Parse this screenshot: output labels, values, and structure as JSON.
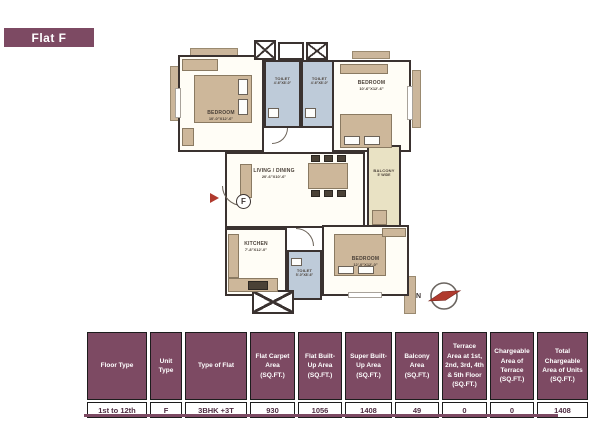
{
  "header": {
    "title": "Flat F"
  },
  "plan": {
    "rooms": [
      {
        "id": "bedroom-top-left",
        "name": "BEDROOM",
        "dims": "10'-0\"X12'-6\""
      },
      {
        "id": "toilet-top-1",
        "name": "TOILET",
        "dims": "4'-6\"X8'-0\""
      },
      {
        "id": "toilet-top-2",
        "name": "TOILET",
        "dims": "4'-6\"X8'-0\""
      },
      {
        "id": "bedroom-top-right",
        "name": "BEDROOM",
        "dims": "10'-6\"X12'-6\""
      },
      {
        "id": "living-dining",
        "name": "LIVING / DINING",
        "dims": "20'-6\"X10'-6\""
      },
      {
        "id": "balcony",
        "name": "BALCONY",
        "dims": "5' WIDE"
      },
      {
        "id": "kitchen",
        "name": "KITCHEN",
        "dims": "7'-8\"X12'-0\""
      },
      {
        "id": "toilet-bottom",
        "name": "TOILET",
        "dims": "5'-0\"X8'-6\""
      },
      {
        "id": "bedroom-bottom-right",
        "name": "BEDROOM",
        "dims": "12'-0\"X12'-0\""
      }
    ],
    "entrance_label": "F",
    "compass_label": "N"
  },
  "table": {
    "headers": [
      "Floor Type",
      "Unit Type",
      "Type of Flat",
      "Flat Carpet Area (SQ.FT.)",
      "Flat Built-Up Area (SQ.FT.)",
      "Super Built-Up Area (SQ.FT.)",
      "Balcony Area (SQ.FT.)",
      "Terrace Area at 1st, 2nd, 3rd, 4th & 5th Floor (SQ.FT.)",
      "Chargeable Area of Terrace (SQ.FT.)",
      "Total Chargeable Area of Units (SQ.FT.)"
    ],
    "row": [
      "1st to 12th",
      "F",
      "3BHK +3T",
      "930",
      "1056",
      "1408",
      "49",
      "0",
      "0",
      "1408"
    ]
  },
  "colors": {
    "accent": "#7d4a63",
    "wall": "#3a3230",
    "toilet_fill": "#becbd9",
    "balcony_fill": "#e9e2c4",
    "furniture": "#cdb79a",
    "entrance_red": "#b03a2e"
  }
}
